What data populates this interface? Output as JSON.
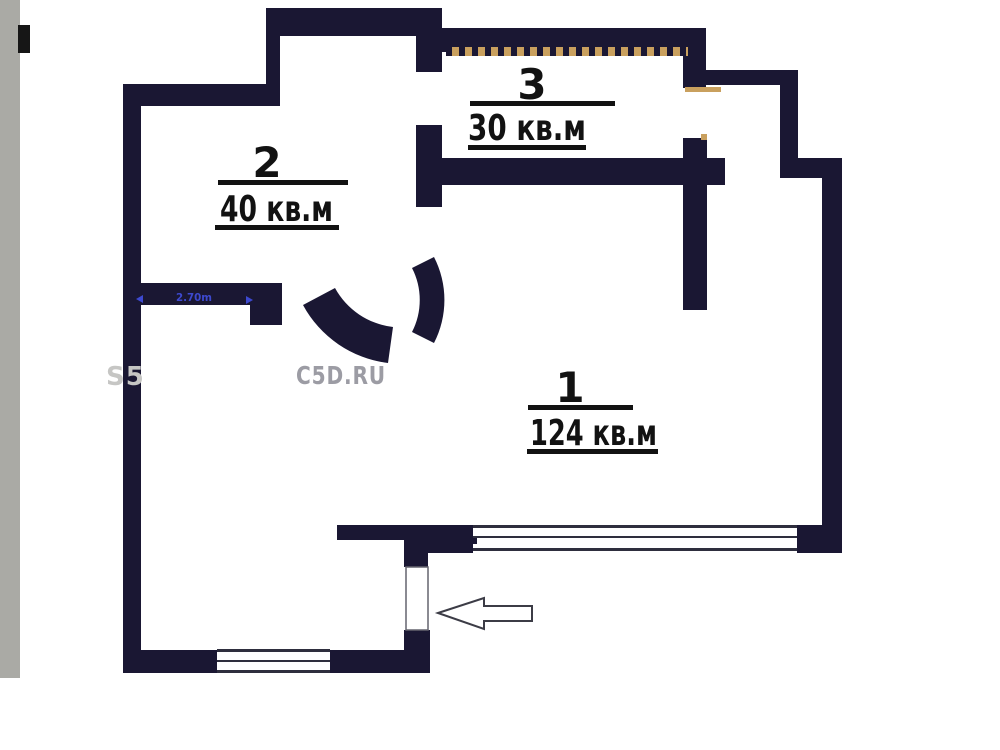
{
  "page": {
    "background": "#ffffff",
    "description_labels": {
      "units_suffix": "кв.м"
    }
  },
  "left_strip": {
    "color": "#aaaaa5",
    "marker_color": "#161616"
  },
  "plan": {
    "rooms": [
      {
        "number": "1",
        "area": "124 кв.м"
      },
      {
        "number": "2",
        "area": "40 кв.м"
      },
      {
        "number": "3",
        "area": "30 кв.м"
      }
    ],
    "dimension": {
      "label": "2.70m",
      "color": "#3d49cf"
    },
    "watermark": {
      "left": "S5",
      "right": "С5D.RU"
    },
    "colors": {
      "wall": "#1a1733",
      "hatch_tan": "#c9a05e",
      "window_line": "#2e2e3e",
      "label_ink": "#121212",
      "watermark_gray": "#9c9ca4",
      "watermark_light": "#c6c6c4"
    }
  }
}
